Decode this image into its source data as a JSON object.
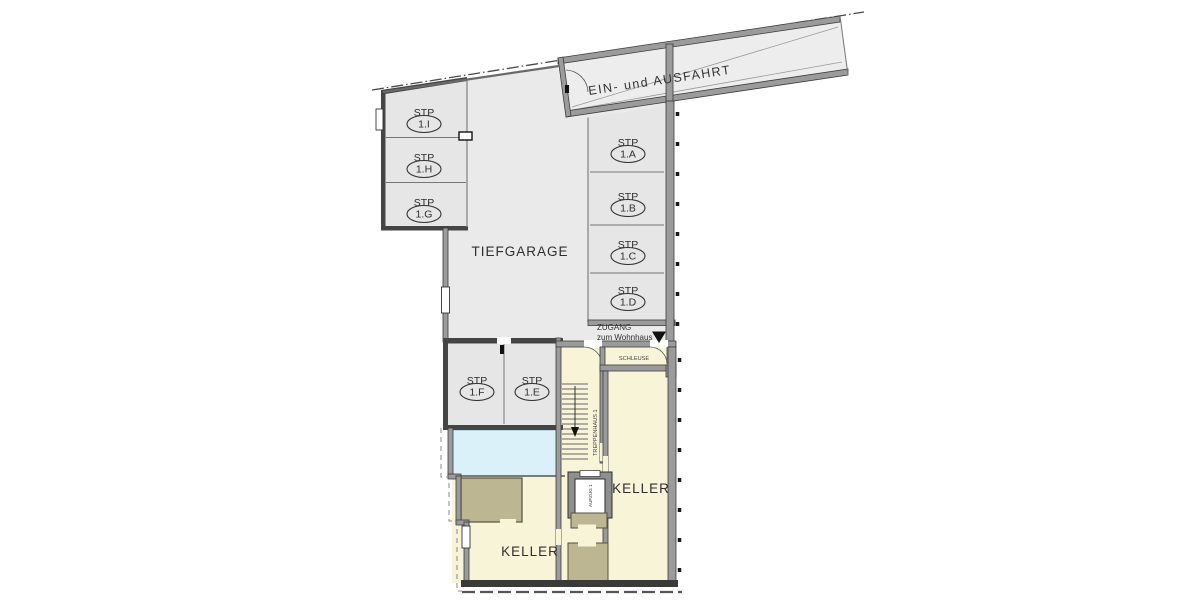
{
  "palette": {
    "floor_gray": "#eaeaea",
    "stall_gray": "#e6e6e6",
    "wall_gray": "#9b9b9b",
    "wall_dark": "#3c3c3c",
    "house_cream": "#f7f4d8",
    "partition_olive": "#bcb692",
    "light_blue": "#daf1fa",
    "label_color": "#2e2e2e"
  },
  "garage": {
    "label": "TIEFGARAGE"
  },
  "ramp": {
    "label": "EIN- und AUSFAHRT"
  },
  "access": {
    "line1": "ZUGANG",
    "line2": "zum Wohnhaus"
  },
  "rooms": {
    "schleuse": "SCHLEUSE",
    "stairwell": "TREPPENHAUS 1",
    "elevator": "AUFZUG 1",
    "keller_left": "KELLER",
    "keller_right": "KELLER"
  },
  "stalls": [
    {
      "code": "STP",
      "num": "1.I"
    },
    {
      "code": "STP",
      "num": "1.H"
    },
    {
      "code": "STP",
      "num": "1.G"
    },
    {
      "code": "STP",
      "num": "1.A"
    },
    {
      "code": "STP",
      "num": "1.B"
    },
    {
      "code": "STP",
      "num": "1.C"
    },
    {
      "code": "STP",
      "num": "1.D"
    },
    {
      "code": "STP",
      "num": "1.F"
    },
    {
      "code": "STP",
      "num": "1.E"
    }
  ]
}
